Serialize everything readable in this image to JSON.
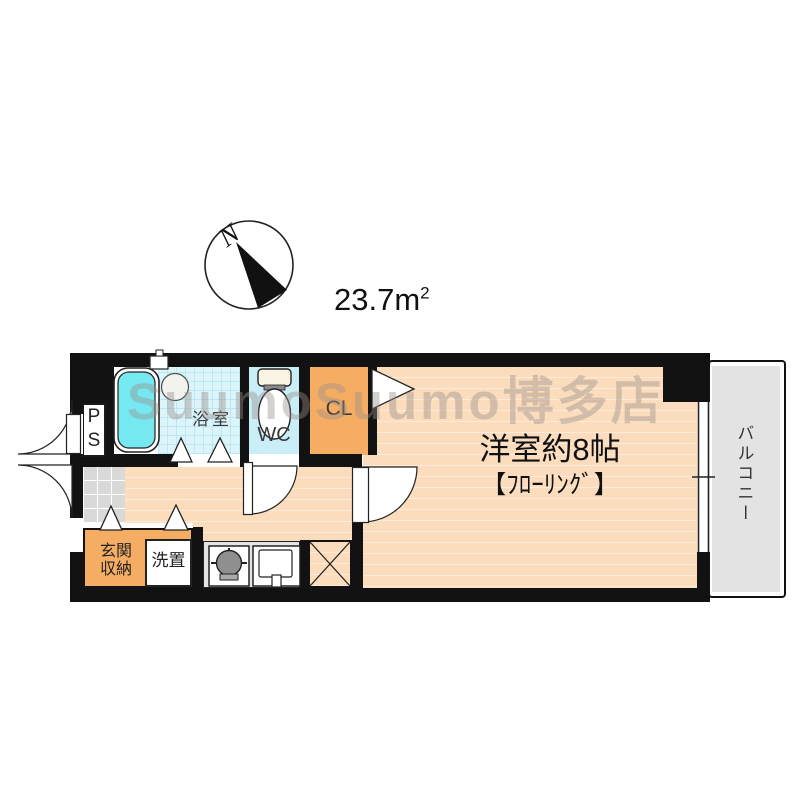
{
  "title": "apartment floor plan",
  "compass": {
    "north_label": "N"
  },
  "area": {
    "value": "23.7",
    "unit_base": "m",
    "unit_exponent": "2"
  },
  "watermark": {
    "text": "SuumoSuumo博多店"
  },
  "rooms": {
    "main_room": {
      "name": "洋室約8帖",
      "floor_note": "【ﾌﾛｰﾘﾝｸﾞ】"
    },
    "bathroom": {
      "name": "浴室"
    },
    "toilet": {
      "name": "WC"
    },
    "closet": {
      "name": "CL"
    },
    "pipe_space": {
      "name": "P\nS"
    },
    "balcony": {
      "name": "バルコニー"
    },
    "entrance_storage": {
      "name": "玄関\n収納"
    },
    "laundry": {
      "name": "洗置"
    }
  },
  "colors": {
    "wall": "#121212",
    "floor": "#fbdcbc",
    "floor-line": "#fdeada",
    "bath-tile": "#dcf4fa",
    "bath-line": "#b8e8f3",
    "tub": "#76e8f2",
    "wc": "#c9eef8",
    "orange": "#f4ad63",
    "genkan": "#d9d9d9",
    "kitchen": "#e4e4e4",
    "balcony": "#e3e3e3"
  }
}
